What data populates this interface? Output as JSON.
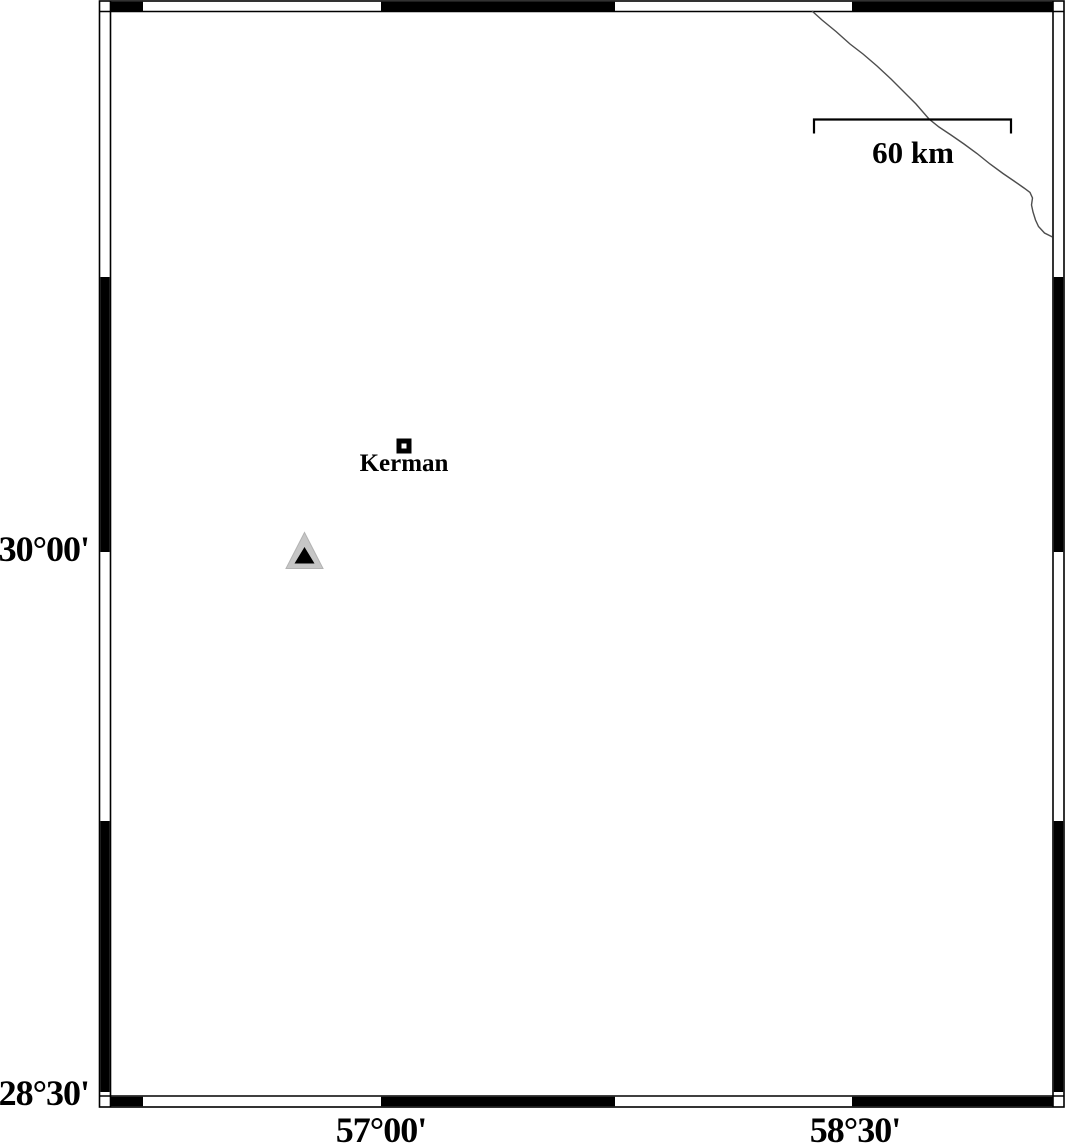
{
  "map_frame": {
    "lat_labels": [
      {
        "text": "30°00'"
      },
      {
        "text": "28°30'"
      }
    ],
    "lon_labels": [
      {
        "text": "57°00'"
      },
      {
        "text": "58°30'"
      }
    ]
  },
  "scale_bar": {
    "label": "60 km"
  },
  "city_marker": {
    "label": "Kerman"
  },
  "markers": {
    "triangle": {
      "fill": "#c6c6c6",
      "inner_fill": "#000000"
    },
    "city_square": {
      "stroke": "#000000",
      "fill": "#ffffff"
    }
  },
  "colors": {
    "ink": "#000000",
    "background": "#ffffff",
    "river_line": "#4d4d4d"
  }
}
